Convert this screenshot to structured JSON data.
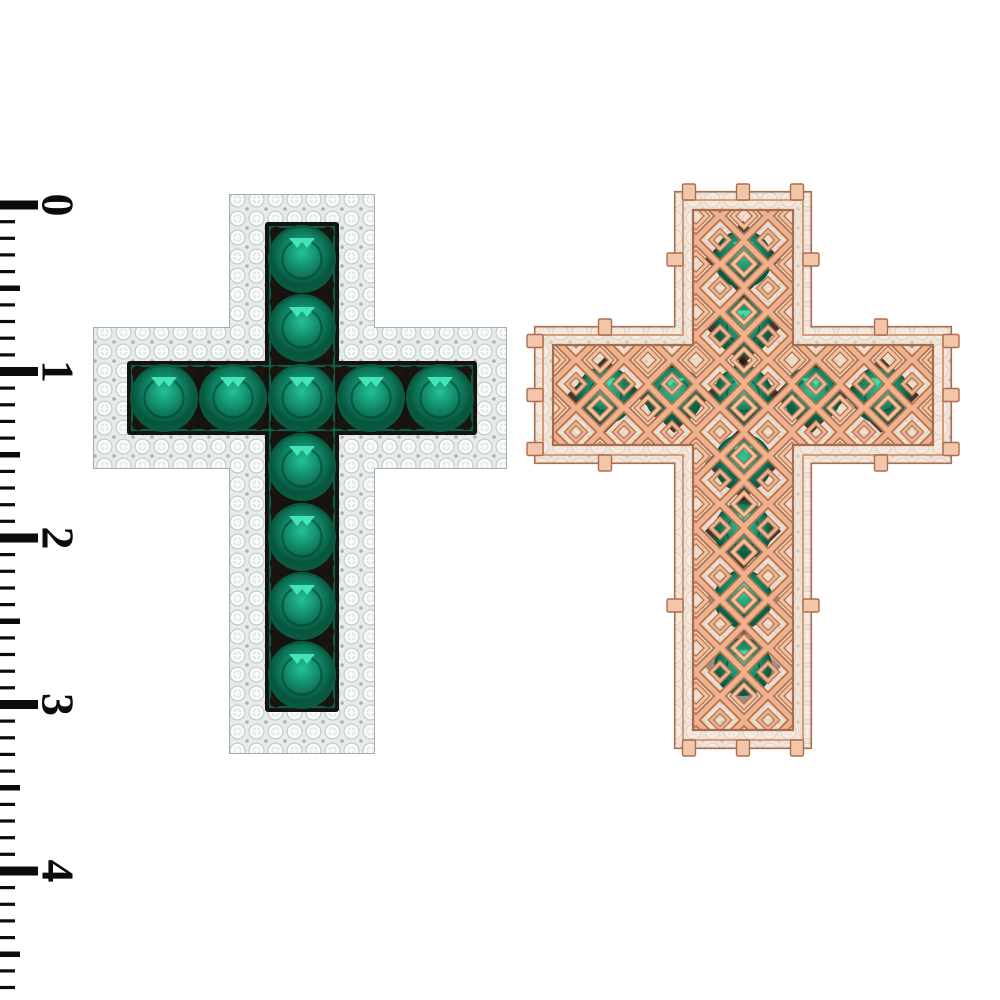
{
  "scene": {
    "width": 1000,
    "height": 1000,
    "background": "#ffffff",
    "subject": "Emerald cross pendant rendered front and back beside a centimeter ruler"
  },
  "ruler": {
    "labels": [
      "0",
      "1",
      "2",
      "3",
      "4"
    ],
    "origin_y": 205,
    "px_per_cm": 166.5,
    "minor_ticks_total": 47,
    "tick_color": "#0b0b0b",
    "label_color": "#0b0b0b",
    "label_x": 58,
    "label_font_size": 46,
    "major": {
      "len": 38,
      "thickness": 9
    },
    "half": {
      "len": 20,
      "thickness": 5.5
    },
    "minor": {
      "len": 15,
      "thickness": 3.2
    }
  },
  "front_cross": {
    "view": "front - white gold with diamond pave border and round emeralds",
    "geometry": {
      "left": 94,
      "right": 506,
      "top": 195,
      "bottom": 753,
      "ax0": 230,
      "ax1": 374,
      "ay0": 328,
      "ay1": 468
    },
    "channel": {
      "vx": 265,
      "vy": 222,
      "vw": 74,
      "vh": 490,
      "hx": 127,
      "hy": 361,
      "hw": 350,
      "hh": 74
    },
    "stones": {
      "radius": 31.5,
      "row_y": 398,
      "row_x": [
        164,
        233,
        302,
        371,
        440
      ],
      "col_x": 302,
      "col_y": [
        259,
        328,
        398,
        467,
        537,
        606,
        675
      ]
    },
    "pave_tile": 19,
    "colors": {
      "metal": "#eff3f2",
      "metal_edge": "#a6acac",
      "pave_bg": "#e7eceb",
      "pave_stone": "#fbfdfd",
      "pave_stone_edge": "#c3cecd",
      "pave_dot": "#a9b3b2",
      "channel": "#16120f",
      "channel_glow": "#0d7150",
      "prong": "#1a140f",
      "emerald_rim": "#0a5a41",
      "emerald_core": "#23c294",
      "emerald_mid": "#108566",
      "emerald_deep": "#07553e",
      "crown_line": "#053a2b",
      "glint": "#49e9bc"
    }
  },
  "back_cross": {
    "view": "back - rose gold filigree openwork with emeralds showing through",
    "geometry": {
      "left": 535,
      "right": 951,
      "top": 192,
      "bottom": 748,
      "ax0": 675,
      "ax1": 811,
      "ay0": 327,
      "ay1": 463
    },
    "stones": {
      "radius": 27,
      "row_y": 395,
      "row_x": [
        605,
        674,
        743,
        812,
        881
      ],
      "col_x": 743,
      "col_y": [
        259,
        327,
        395,
        463,
        531,
        599,
        667
      ]
    },
    "lattice_tile": 48,
    "tab": {
      "w": 13,
      "h": 16
    },
    "colors": {
      "gold_light": "#f7ddc9",
      "gold_edge": "#ad6c4d",
      "gold_line2": "#d1946f",
      "panel": "#f1d3ba",
      "panel_edge": "#a96d4e",
      "lattice_dark": "#b5714f",
      "lattice_light": "#eeb28f",
      "lattice_light2": "#f4c29f",
      "tab_fill": "#f2c6a8",
      "shadow": "#241b15",
      "emerald_rim": "#0a5a41",
      "emerald_core": "#2cc99b",
      "emerald_mid": "#12926d",
      "emerald_deep": "#086049",
      "glint": "#3fe0ad"
    }
  }
}
